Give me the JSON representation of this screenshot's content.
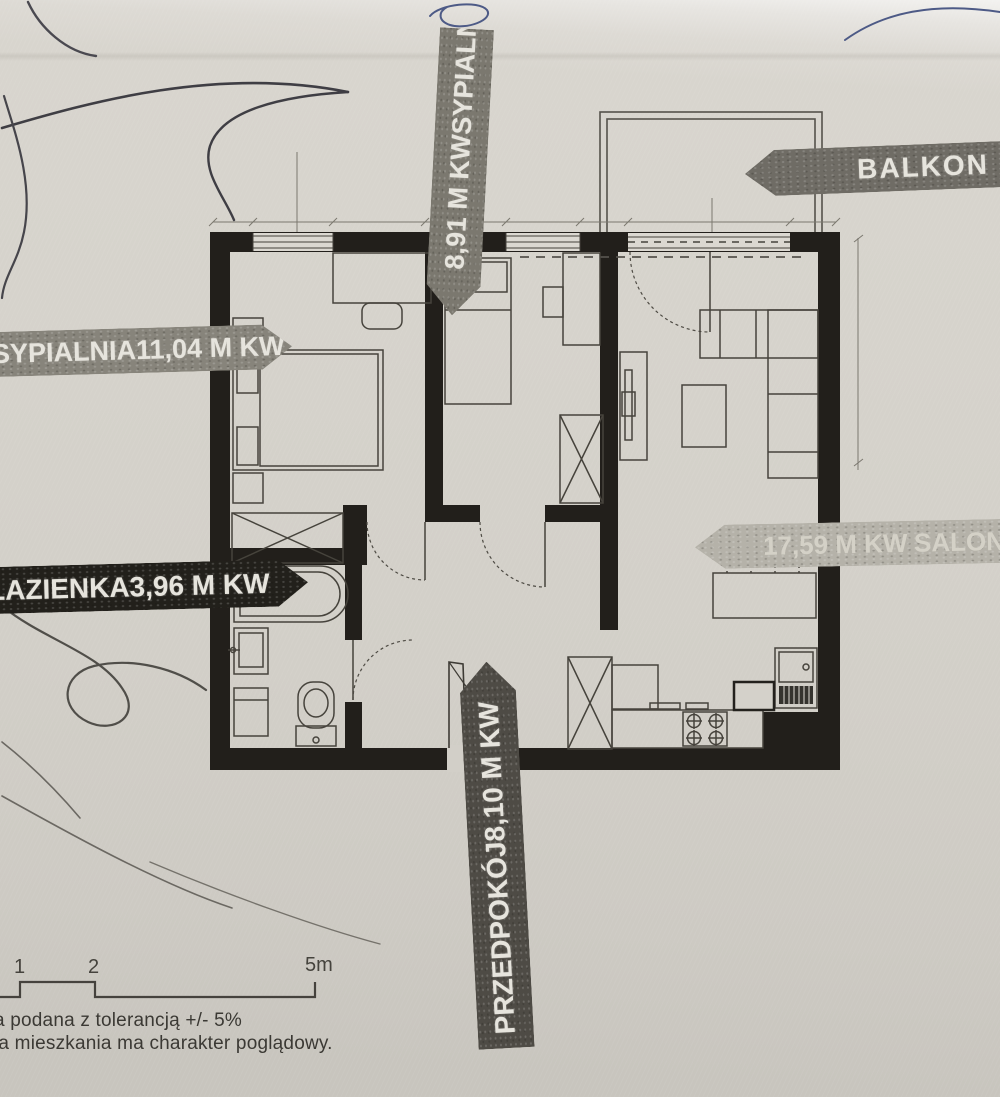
{
  "banners": {
    "bedroom_right": {
      "label": "SYPIALNIA",
      "area": "8,91 M KW"
    },
    "balcony": {
      "label": "BALKON"
    },
    "bedroom_left": {
      "label": "SYPIALNIA",
      "area": "11,04 M KW"
    },
    "bathroom": {
      "label": "ŁAZIENKA",
      "area": "3,96 M KW"
    },
    "living_room": {
      "label": "SALON",
      "area": "17,59 M KW"
    },
    "hallway": {
      "label": "PRZEDPOKÓJ",
      "area": "8,10 M KW"
    }
  },
  "scale_bar": {
    "ticks": [
      "1",
      "2",
      "5m"
    ]
  },
  "footer": {
    "line1": "a podana z tolerancją +/- 5%",
    "line2": "ja mieszkania ma charakter poglądowy."
  },
  "colors": {
    "paper": "#d5d2cb",
    "ink": "#221f1b",
    "banner_grey": "#85827a",
    "banner_dark": "#22201b",
    "banner_faint": "#b5b2a9",
    "pen_blue": "#4d5a86"
  }
}
